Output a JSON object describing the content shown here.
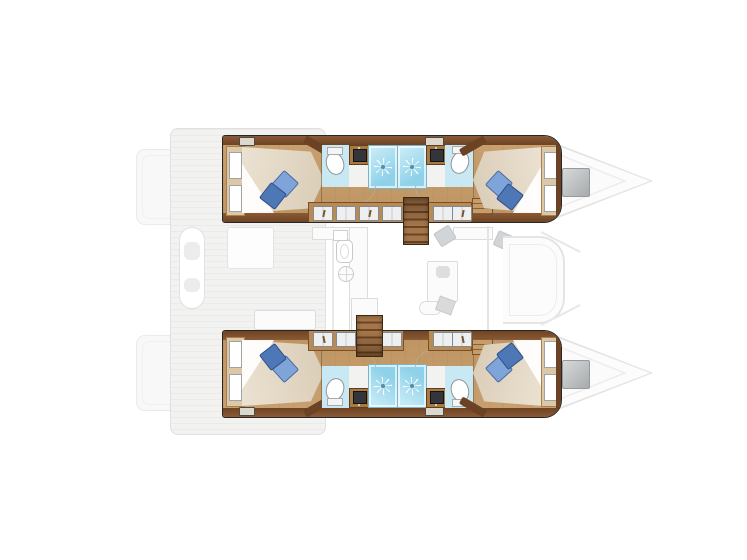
{
  "diagram": {
    "type": "catamaran-interior-floorplan",
    "view": "top-down",
    "orientation": {
      "bow": "right",
      "stern": "left",
      "port_hull": "top",
      "starboard_hull": "bottom"
    },
    "hulls": [
      {
        "id": "port-hull",
        "rooms": [
          "aft double cabin",
          "aft bathroom",
          "aft shower stall",
          "forward shower stall",
          "forward bathroom",
          "forward double cabin"
        ],
        "fixtures": [
          "headboard windows",
          "double berth",
          "two pillows",
          "toilet",
          "vanity sink",
          "wardrobe lockers",
          "companionway stairs",
          "deck hatches"
        ]
      },
      {
        "id": "starboard-hull",
        "rooms": [
          "aft double cabin",
          "aft bathroom",
          "aft shower stall",
          "forward shower stall",
          "forward bathroom",
          "forward double cabin"
        ],
        "fixtures": [
          "headboard windows",
          "double berth",
          "two pillows",
          "toilet",
          "vanity sink",
          "wardrobe lockers",
          "companionway stairs",
          "deck hatches"
        ]
      },
      {
        "cabins_total": 4,
        "bathrooms_total": 4,
        "showers_total": 4
      }
    ],
    "bridgedeck": {
      "areas": [
        "aft cockpit with bench and table",
        "galley with sink and stove",
        "saloon table and seating",
        "navigation seats",
        "forward C-shaped sofa"
      ],
      "style": "faint gray outline"
    },
    "exterior": [
      "stern swim platforms",
      "aft deck with plank lines",
      "pointed bows",
      "foredeck hatches"
    ]
  },
  "icons": {
    "shower_jets": "white starburst on cyan floor",
    "stove_burner": "circle with cross lines",
    "toilet": "white oval with tank",
    "vanity_sink": "dark square basin on wood counter",
    "foredeck_hatch": "gray gradient square",
    "wardrobe_hanger": "small brown hanger stroke"
  },
  "colors": {
    "hull_outline": "#262626",
    "wood_band_1": "#8a5a36",
    "wood_band_2": "#6e4424",
    "wood_floor_1": "#c9a170",
    "wood_floor_2": "#bd9462",
    "wood_trim": "#6b4223",
    "counter_wood": "#a9793f",
    "wardrobe_wood": "#b78a56",
    "headboard_wood": "#dcc7a6",
    "mattress_1": "#ece2d2",
    "mattress_2": "#d9ccb6",
    "sheet": "#ffffff",
    "pillow_light": "#7fa4da",
    "pillow_dark": "#4e77b6",
    "bath_floor": "#c8e9f4",
    "shower_1": "#c6ebf6",
    "shower_2": "#8ed1e9",
    "shower_border": "#79b4cb",
    "sink_dark": "#33353b",
    "porcelain": "#ffffff",
    "fixture_line": "#8f9496",
    "stair_light": "#a4764a",
    "stair_dark": "#6a4526",
    "exterior_fill": "#f2f2f1",
    "exterior_line": "#e0e0e0",
    "faint_fill": "#fbfbfb",
    "faint_line": "#dcdcdc",
    "hatch_1": "#d6d9da",
    "hatch_2": "#a7abad",
    "panel_white": "#edeff1",
    "panel_line": "#85898e"
  }
}
